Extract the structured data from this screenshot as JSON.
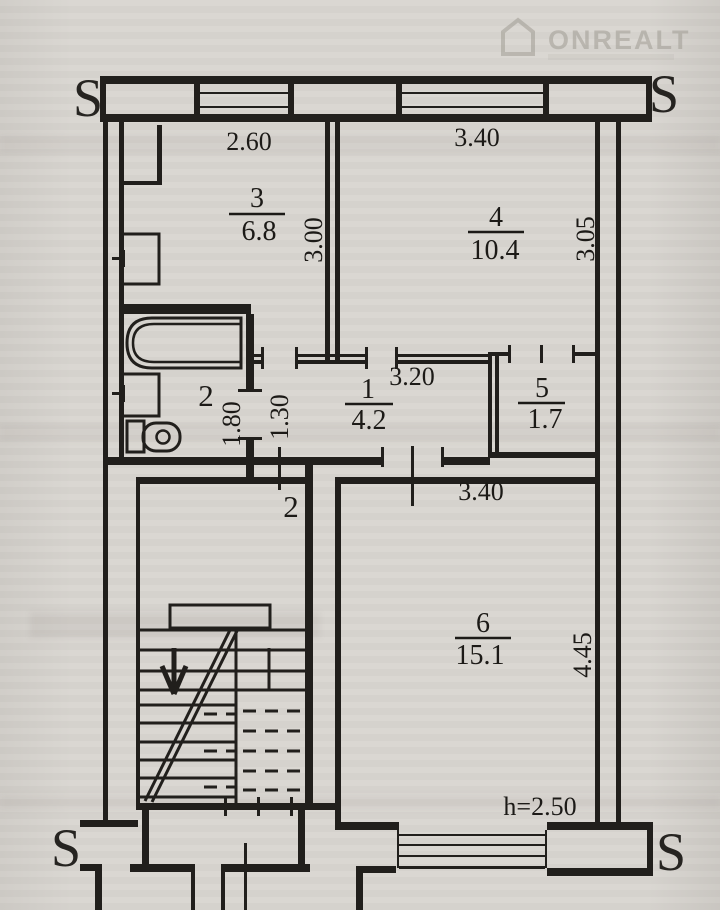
{
  "watermark": {
    "brand": "ONREALT"
  },
  "compass": {
    "top_left": "S",
    "top_right": "S",
    "bottom_left": "S",
    "bottom_right": "S"
  },
  "rooms": {
    "kitchen": {
      "number": "3",
      "area": "6.8"
    },
    "room4": {
      "number": "4",
      "area": "10.4"
    },
    "hall": {
      "number": "1",
      "area": "4.2"
    },
    "bath": {
      "number": "2"
    },
    "closet": {
      "number": "5",
      "area": "1.7"
    },
    "living": {
      "number": "6",
      "area": "15.1"
    }
  },
  "dims": {
    "kitchen_window": "2.60",
    "room4_window": "3.40",
    "kitchen_depth": "3.00",
    "room4_depth": "3.05",
    "hall_width": "3.20",
    "bath_width": "1.80",
    "hall_arm_width": "1.30",
    "living_width": "3.40",
    "living_depth": "4.45"
  },
  "entrance": {
    "apartment_number": "2"
  },
  "ceiling_height": "h=2.50"
}
